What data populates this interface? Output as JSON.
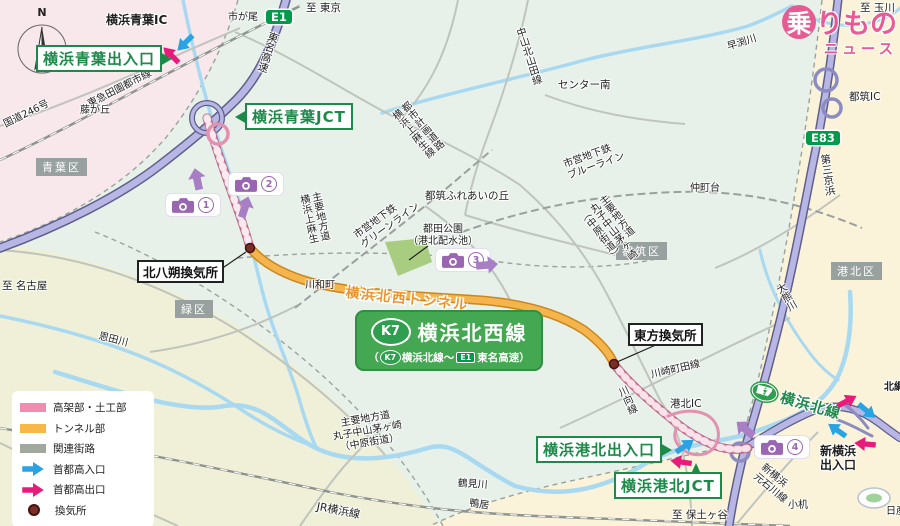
{
  "watermark": {
    "char1": "乗",
    "rest": "りもの",
    "line2": "ニュース"
  },
  "compass": {
    "label": "N"
  },
  "main_badge": {
    "marker": "K7",
    "title": "横浜北西線",
    "sub_open": "（",
    "sub_marker": "K7",
    "sub_mid": "横浜北線〜",
    "sub_e1": "E1",
    "sub_tail": "東名高速）"
  },
  "route_markers": {
    "e1": "E1",
    "e83": "E83",
    "k7_map": "K7"
  },
  "route_labels": {
    "tunnel": "横浜北西トンネル",
    "k7_kita": "横浜北線"
  },
  "boxed_labels": {
    "aoba_exit": "横浜青葉出入口",
    "aoba_jct": "横浜青葉JCT",
    "kohoku_exit": "横浜港北出入口",
    "kohoku_jct": "横浜港北JCT",
    "kitahassaku_vent": "北八朔換気所",
    "toho_vent": "東方換気所"
  },
  "wards": {
    "aoba": "青葉区",
    "midori": "緑区",
    "tsuzuki": "都筑区",
    "kohoku": "港北区"
  },
  "directions": {
    "tokyo": "至 東京",
    "tamagawa": "至 玉川",
    "nagoya": "至 名古屋",
    "hodogaya": "至 保土ヶ谷"
  },
  "places": {
    "yokohama_aoba_ic": "横浜青葉IC",
    "ichigao": "市が尾",
    "fujigaoka": "藤が丘",
    "center_minami": "センター南",
    "fureai": "都筑ふれあいの丘",
    "tsuda_park": "都田公園\n（港北配水池）",
    "nakamachidai": "仲町台",
    "kawawacho": "川和町",
    "tsuzuki_ic": "都筑IC",
    "kohoku_ic": "港北IC",
    "shin_yokohama_exit": "新横浜\n出入口",
    "kozukue": "小机",
    "kamoi": "鴨居",
    "kitatsunashima": "北綱",
    "nissan": "日産"
  },
  "roads": {
    "tomei": "東名高速",
    "route246": "国道246号",
    "daisan_keihin": "第三京浜",
    "plan_road": "都市計画道路\n横浜上麻生線",
    "kamiasao": "主要地方道\n横浜上麻生",
    "nakayama_kitayamata": "中山北山田線",
    "pref_road_ne": "主要地方道\n丸子中山茅ヶ崎\n（中原街道）",
    "pref_road_sw": "主要地方道\n丸子中山茅ヶ崎\n（中原街道）",
    "kawasaki_machida": "川崎町田線",
    "kawamukai": "川向線",
    "motoishikawa": "新横浜\n元石川線"
  },
  "rivers": {
    "hayabuchi": "早渕川",
    "onda": "恩田川",
    "tsurumi": "鶴見川",
    "okuma": "大熊川"
  },
  "transit": {
    "denentoshi": "東急田園都市線",
    "jr_yokohama": "JR横浜線",
    "green_line": "市営地下鉄\nグリーンライン",
    "blue_line": "市営地下鉄\nブルーライン"
  },
  "cameras": {
    "c1": "1",
    "c2": "2",
    "c3": "3",
    "c4": "4"
  },
  "legend": {
    "items": [
      {
        "label": "高架部・土工部",
        "swatch": "#f08cb0"
      },
      {
        "label": "トンネル部",
        "swatch": "#f8b848"
      },
      {
        "label": "関連街路",
        "swatch": "#a3a89e"
      },
      {
        "label": "首都高入口",
        "swatch": "#29a3e3"
      },
      {
        "label": "首都高出口",
        "swatch": "#e81b7d"
      },
      {
        "label": "換気所",
        "swatch": "#7b2d26"
      }
    ]
  },
  "colors": {
    "route_pink": "#f3a9c2",
    "route_orange": "#f6b44c",
    "expressway_lavender": "#b8b6e4",
    "water_blue": "#a9d9f0",
    "label_green": "#1d8a4a",
    "badge_green": "#44a852",
    "entry_blue": "#29a3e3",
    "exit_pink": "#e81b7d",
    "camera_purple": "#9a66b2"
  }
}
